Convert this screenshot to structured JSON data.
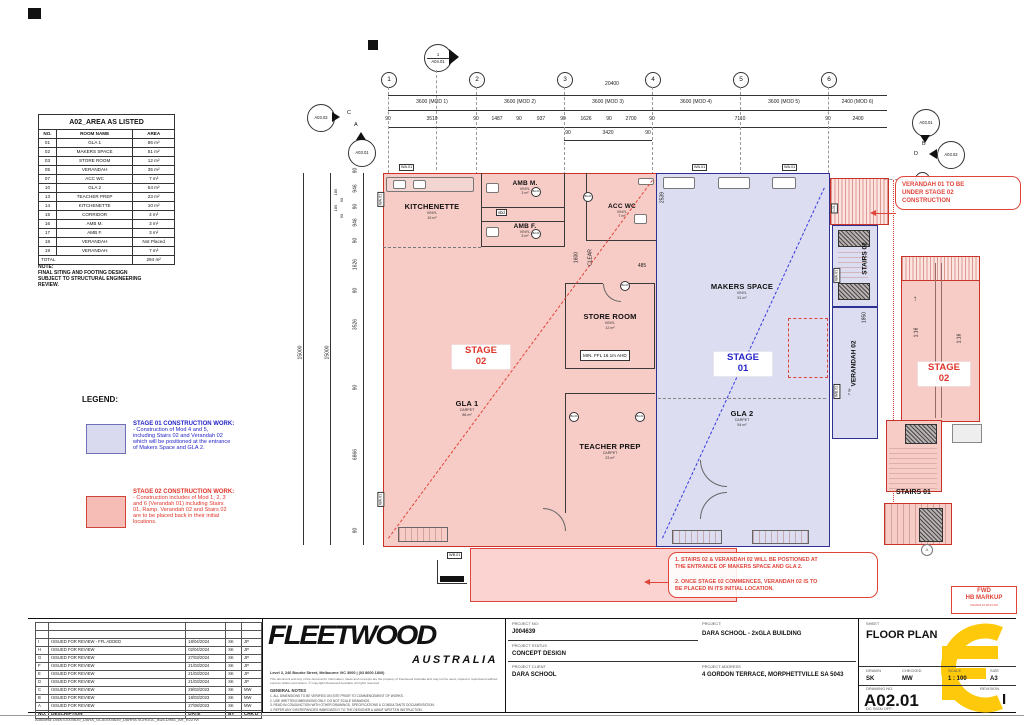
{
  "area_table": {
    "title": "A02_AREA AS LISTED",
    "col_no": "NO.",
    "col_name": "ROOM NAME",
    "col_area": "AREA",
    "rows": [
      {
        "no": "01",
        "name": "GLA 1",
        "area": "86 m²"
      },
      {
        "no": "02",
        "name": "MAKERS SPACE",
        "area": "51 m²"
      },
      {
        "no": "03",
        "name": "STORE ROOM",
        "area": "12 m²"
      },
      {
        "no": "05",
        "name": "VERANDAH",
        "area": "35 m²"
      },
      {
        "no": "07",
        "name": "ACC WC",
        "area": "7 m²"
      },
      {
        "no": "10",
        "name": "GLA 2",
        "area": "54 m²"
      },
      {
        "no": "13",
        "name": "TEACHER PREP",
        "area": "23 m²"
      },
      {
        "no": "14",
        "name": "KITCHENETTE",
        "area": "10 m²"
      },
      {
        "no": "15",
        "name": "CORRIDOR",
        "area": "4 m²"
      },
      {
        "no": "16",
        "name": "AMB M.",
        "area": "3 m²"
      },
      {
        "no": "17",
        "name": "AMB F.",
        "area": "3 m²"
      },
      {
        "no": "18",
        "name": "VERANDAH",
        "area": "Not Placed"
      },
      {
        "no": "19",
        "name": "VERANDAH",
        "area": "7 m²"
      }
    ],
    "total_label": "TOTAL",
    "total_value": "294 m²"
  },
  "note": {
    "title": "NOTE:",
    "body": "FINAL SITING AND FOOTING DESIGN\nSUBJECT TO STRUCTURAL ENGINEERING\nREVIEW."
  },
  "legend": {
    "title": "LEGEND:",
    "stage01_title": "STAGE 01 CONSTRUCTION WORK:",
    "stage01_body": "- Construction of Mod 4 and 5,\nincluding Stairs 02 and Verandah 02\nwhich will be positioned at the entrance\nof Makers Space and GLA 2.",
    "stage02_title": "STAGE 02 CONSTRUCTION WORK:",
    "stage02_body": "- Construction includes of Mod 1, 2, 3\nand 6 (Verandah 01) including Stairs\n01, Ramp. Verandah 02 and Stairs 02\nare to be placed back in their initial\nlocations.",
    "stage01_color": "#d9daf0",
    "stage02_color": "#f6bcb6"
  },
  "grid": {
    "b1": "1",
    "b2": "2",
    "b3": "3",
    "b4": "4",
    "b5": "5",
    "b6": "6",
    "row_a": "A",
    "row_b": "B",
    "row_c": "C",
    "row_d": "D"
  },
  "markers": {
    "section_num": "1",
    "section_ref": "A04.01",
    "left_outer": "A03.02",
    "left_inner": "A03.01",
    "right_inner": "A03.01",
    "right_outer": "A03.02"
  },
  "dims": {
    "overall_top": "20400",
    "mod1": "3600 (MOD 1)",
    "mod2": "3600 (MOD 2)",
    "mod3": "3600 (MOD 3)",
    "mod4": "3600 (MOD 4)",
    "mod5": "3600 (MOD 5)",
    "mod6": "2400 (MOD 6)",
    "detail_top": [
      "90",
      "3510",
      "90",
      "1487",
      "90",
      "937",
      "90",
      "1626",
      "90",
      "2700",
      "90",
      "7110",
      "90",
      "2400"
    ],
    "sub_top": [
      "90",
      "3420",
      "90"
    ],
    "overall_left_1": "15000",
    "overall_left_2": "15000",
    "left_chain": [
      "90",
      "946",
      "90",
      "946",
      "90",
      "1626",
      "90",
      "3526",
      "90",
      "6866",
      "90"
    ],
    "callouts": [
      "185",
      "90",
      "185",
      "90"
    ],
    "clear_dim": "1600",
    "clear_label": "CLEAR",
    "d485": "485",
    "d2539": "2539",
    "d1850": "1850"
  },
  "plan": {
    "rooms": {
      "kitchenette": {
        "name": "KITCHENETTE",
        "finish": "VINYL",
        "area": "10 m²"
      },
      "amb_m": {
        "name": "AMB M.",
        "finish": "VINYL",
        "area": "3 m²"
      },
      "amb_f": {
        "name": "AMB F.",
        "finish": "VINYL",
        "area": "3 m²"
      },
      "acc_wc": {
        "name": "ACC WC",
        "finish": "VINYL",
        "area": "7 m²"
      },
      "store": {
        "name": "STORE ROOM",
        "finish": "VINYL",
        "area": "12 m²",
        "ffl": "MIN. FFL 16.1m AHD"
      },
      "gla1": {
        "name": "GLA 1",
        "finish": "CARPET",
        "area": "86 m²"
      },
      "teacher": {
        "name": "TEACHER PREP",
        "finish": "CARPET",
        "area": "23 m²"
      },
      "makers": {
        "name": "MAKERS SPACE",
        "finish": "VINYL",
        "area": "51 m²"
      },
      "gla2": {
        "name": "GLA 2",
        "finish": "CARPET",
        "area": "54 m²"
      },
      "stairs02": "STAIRS 02",
      "verandah02": "VERANDAH 02",
      "verandah02_area": "7 m²",
      "stairs01": "STAIRS 01",
      "vbd": "vbd"
    },
    "stage01_line1": "STAGE",
    "stage01_line2": "01",
    "stage02_line1": "STAGE",
    "stage02_line2": "02",
    "ramp_slope": "1:16",
    "up_arrow": "↑",
    "tags": {
      "wa": "WA.01",
      "wb": "WB.01",
      "l01": "L01",
      "door": "BA.01",
      "a_ref": "A"
    },
    "colors": {
      "stage01_fill": "#dcddf1",
      "stage01_line": "#2e3192",
      "stage02_fill": "#f7cbc6",
      "stage02_line": "#c9342a"
    }
  },
  "clouds": {
    "right": "VERANDAH 01 TO BE\nUNDER STAGE 02\nCONSTRUCTION",
    "bottom": "1. STAIRS 02 & VERANDAH 02 WILL BE POSTIONED AT\nTHE ENTRANCE OF MAKERS SPACE AND GLA 2.\n\n2. ONCE STAGE 02 COMMENCES, VERANDAH 02 IS TO\nBE PLACED IN ITS INITIAL LOCATION."
  },
  "titleblock": {
    "company": "FLEETWOOD",
    "country": "AUSTRALIA",
    "address": "Level 3, 246 Bourke Street, Melbourne VIC 3000 | (03 8600 1800)",
    "disclaimer": "This document and any of the documents' information, ideas and concepts are the property of Fleetwood Australia and may not be used, copied or reproduced without express written permission. © Copyright Fleetwood Australia. All rights reserved.",
    "general_notes_title": "GENERAL NOTES",
    "general_notes": "1. ALL DIMENSIONS TO BE VERIFIED ON SITE PRIOR TO COMMENCEMENT OF WORKS.\n2. USE WRITTEN DIMENSIONS ONLY. DO NOT SCALE DRAWINGS.\n3. READ IN CONJUNCTION WITH OTHER DRAWINGS, SPECIFICATIONS & CONSULTANTS DOCUMENTATION.\n4. REFER ANY DISCREPANCIES IMMEDIATELY TO THE DESIGNER & AWAIT WRITTEN INSTRUCTION.",
    "project_no_label": "PROJECT  NO:",
    "project_no": "J004639",
    "status_label": "PROJECT STATUS",
    "status": "CONCEPT DESIGN",
    "client_label": "PROJECT CLIENT",
    "client": "DARA SCHOOL",
    "project_label": "PROJECT:",
    "project": "DARA SCHOOL - 2xGLA BUILDING",
    "address_label": "PROJECT ADDRESS",
    "project_address": "4 GORDON TERRACE, MORPHETTVILLE SA 5043",
    "sheet_label": "SHEET",
    "sheet": "FLOOR PLAN",
    "drawn_label": "DRAWN",
    "drawn": "SK",
    "checked_label": "CHECKED",
    "checked": "MW",
    "scale_label": "SCALE",
    "scale": "1 : 100",
    "size_label": "SIZE",
    "size": "A3",
    "drawing_no_label": "DRAWING NO.",
    "drawing_no": "A02.01",
    "revision_label": "REVISION",
    "revision": "I",
    "dc_label": "DC SIGN OFF:",
    "stamp_line1": "FWD",
    "stamp_line2": "HB MARKUP",
    "stamp_date": "9/2/2024 10:28:44 AM"
  },
  "revisions": {
    "header": {
      "no": "NO.",
      "desc": "DESCRIPTION",
      "date": "DATE",
      "by": "BY",
      "chk": "CHK'D"
    },
    "rows": [
      {
        "no": "I",
        "desc": "ISSUED FOR REVIEW - FFL ADDED",
        "date": "18/04/2024",
        "by": "SK",
        "chk": "JP"
      },
      {
        "no": "H",
        "desc": "ISSUED FOR REVIEW",
        "date": "02/04/2024",
        "by": "SK",
        "chk": "JP"
      },
      {
        "no": "G",
        "desc": "ISSUED FOR REVIEW",
        "date": "27/03/2024",
        "by": "SK",
        "chk": "JP"
      },
      {
        "no": "F",
        "desc": "ISSUED FOR REVIEW",
        "date": "21/03/2024",
        "by": "SK",
        "chk": "JP"
      },
      {
        "no": "E",
        "desc": "ISSUED FOR REVIEW",
        "date": "21/03/2024",
        "by": "SK",
        "chk": "JP"
      },
      {
        "no": "D",
        "desc": "ISSUED FOR REVIEW",
        "date": "21/03/2024",
        "by": "SK",
        "chk": "JP"
      },
      {
        "no": "C",
        "desc": "ISSUED FOR REVIEW",
        "date": "29/03/2023",
        "by": "SK",
        "chk": "MW"
      },
      {
        "no": "B",
        "desc": "ISSUED FOR REVIEW",
        "date": "18/03/2023",
        "by": "SK",
        "chk": "MW"
      },
      {
        "no": "A",
        "desc": "ISSUED FOR REVIEW",
        "date": "27/08/2023",
        "by": "SK",
        "chk": "MW"
      }
    ]
  },
  "page": {
    "footnote": "Autodesk Docs://J004639_DARA_GLA/J004639_DARRA SCHOOL_BUILDING_AR_R22.rvt"
  }
}
